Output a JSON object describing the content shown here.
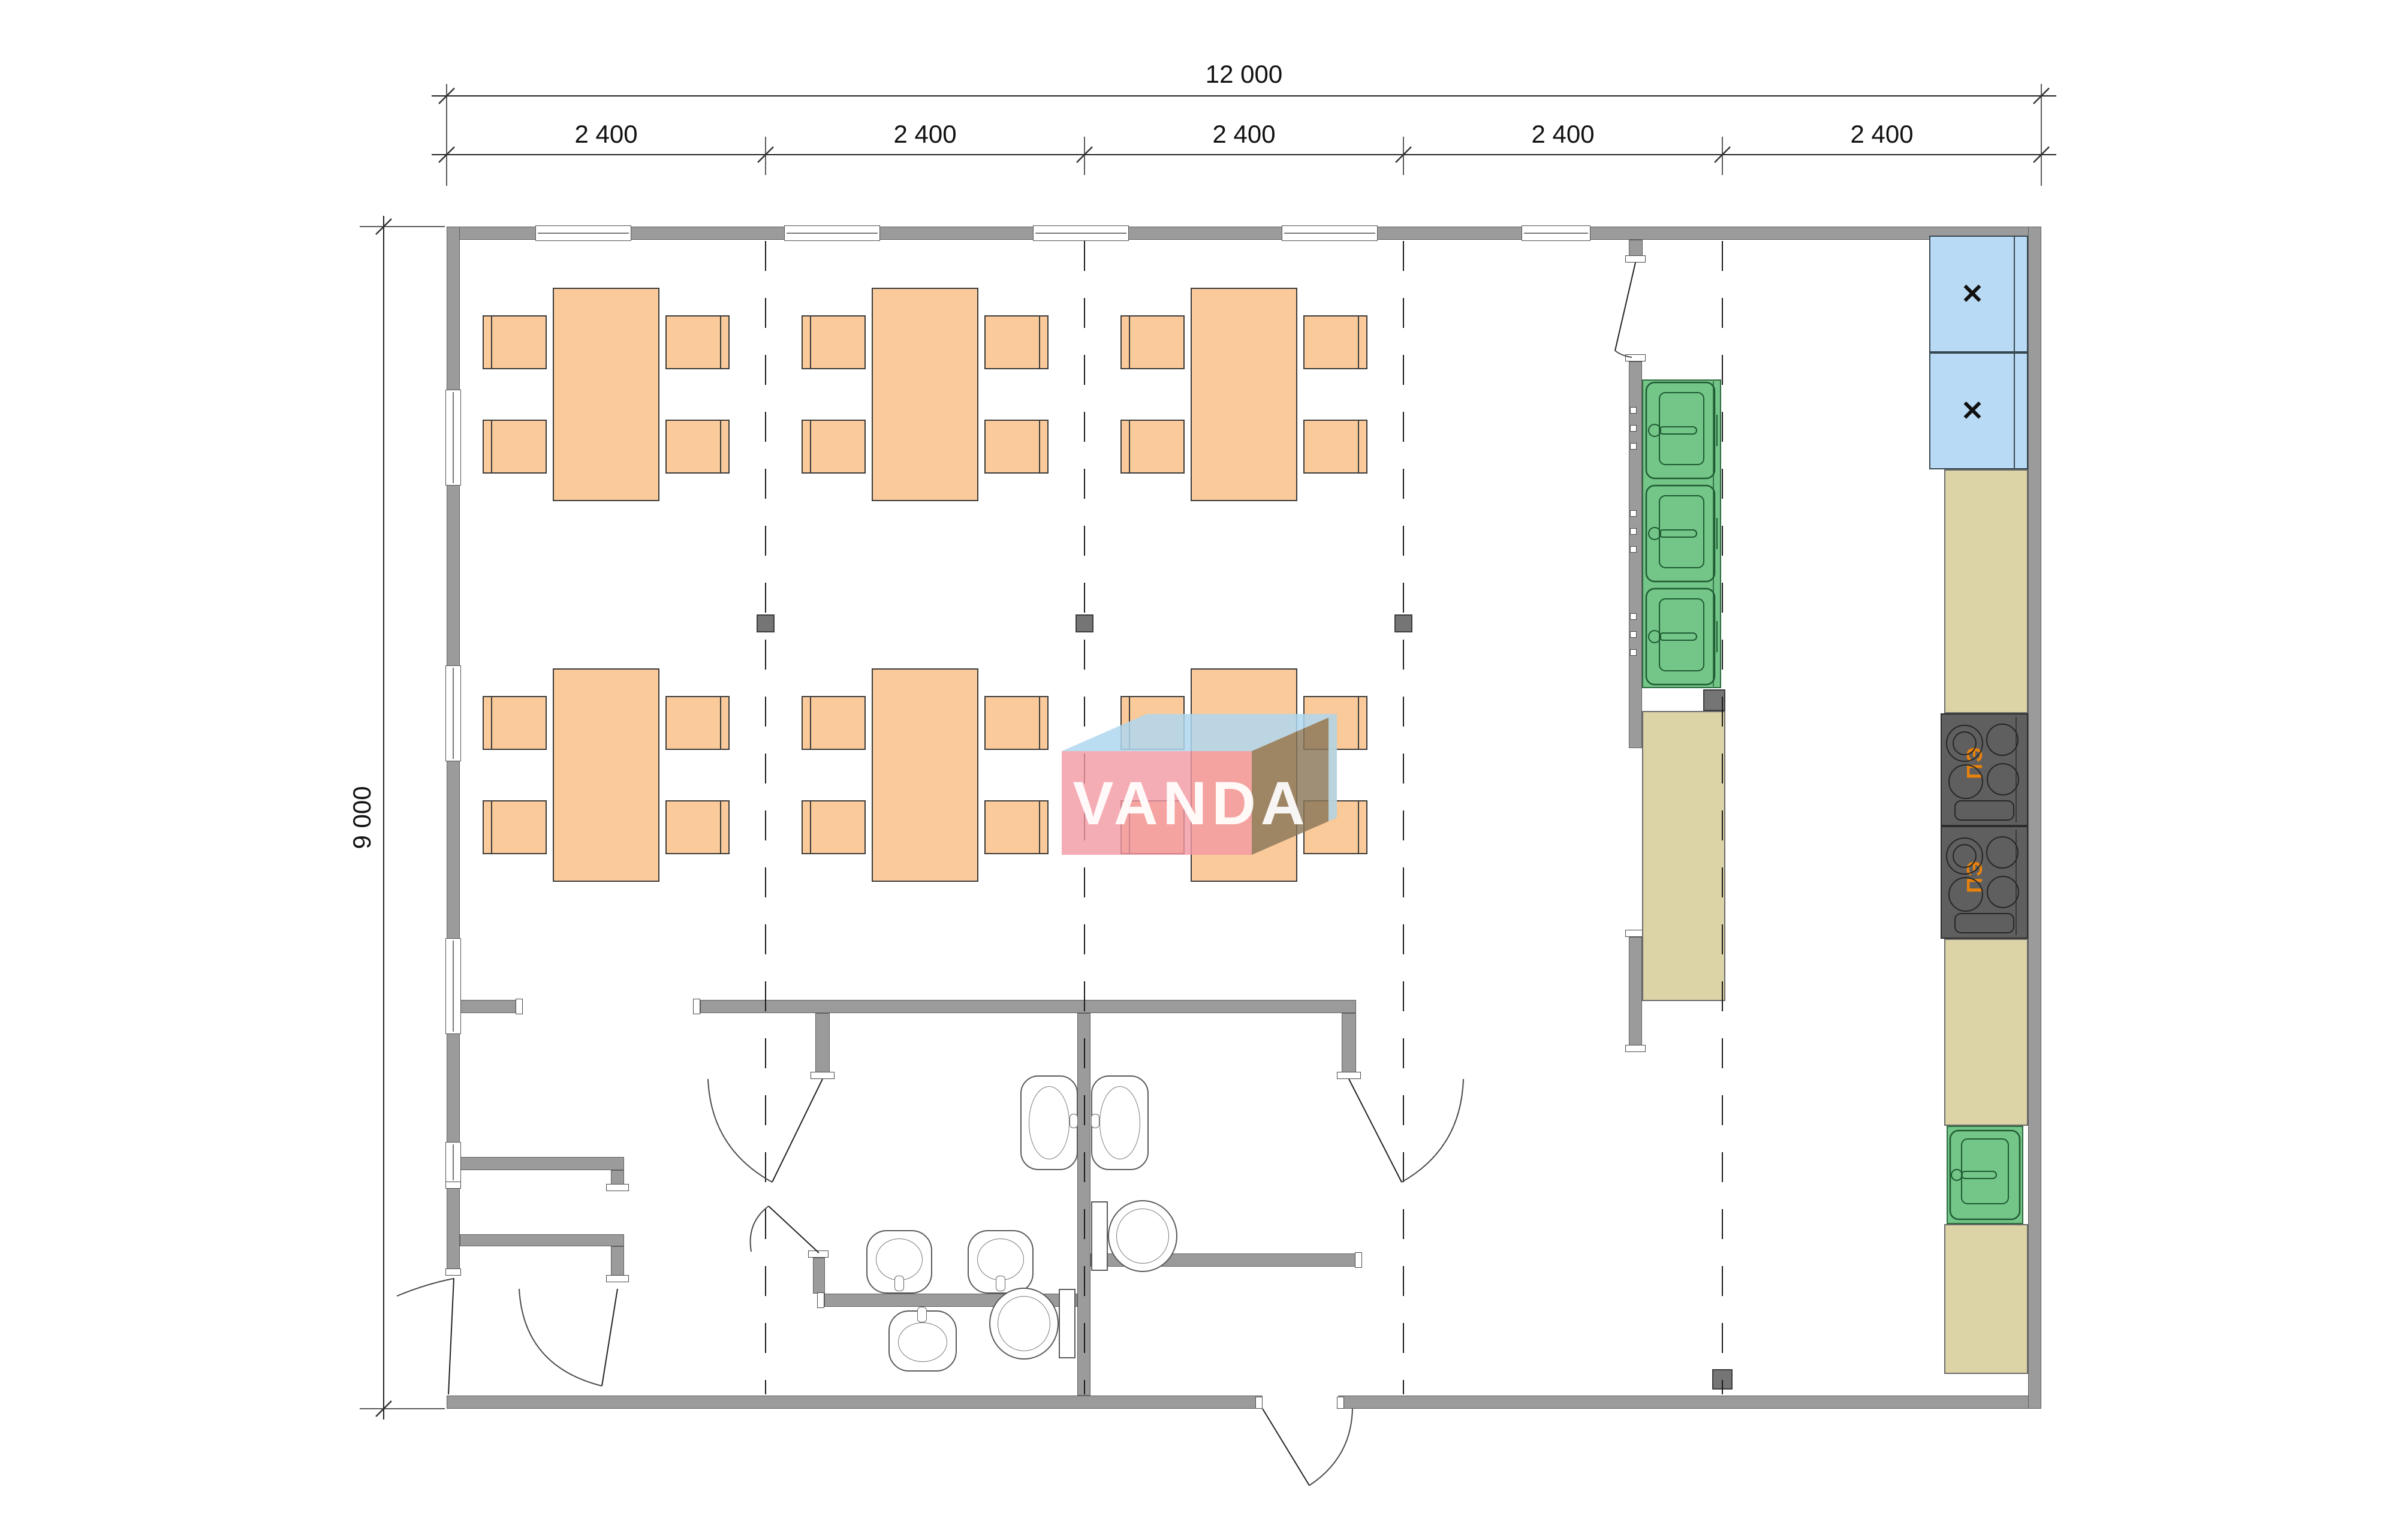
{
  "drawing": {
    "type": "architectural-floor-plan",
    "dimensions": {
      "overall_width_label": "12 000",
      "overall_height_label": "9 000",
      "bay_labels": [
        "2 400",
        "2 400",
        "2 400",
        "2 400",
        "2 400"
      ]
    },
    "watermark": {
      "text": "VANDA"
    },
    "equipment": {
      "stove_label": "ПЭ",
      "fridge_mark": "✕",
      "tables": 6,
      "chairs_per_table": 4,
      "wash_sinks": 3,
      "kitchen_single_sink": 1,
      "fridges": 2,
      "stoves": 2,
      "toilets": 2,
      "hand_basins": 5
    },
    "colors": {
      "wall": "#9B9B9B",
      "furniture": "#FACA9B",
      "counter": "#DCD3A6",
      "sink": "#74C588",
      "fridge": "#B9DAF5",
      "stove": "#5F5F5F",
      "stove_label_color": "#E8820C",
      "watermark_front": "#F299A3",
      "watermark_top": "#AFD7EE",
      "watermark_side": "#8A7658"
    }
  }
}
